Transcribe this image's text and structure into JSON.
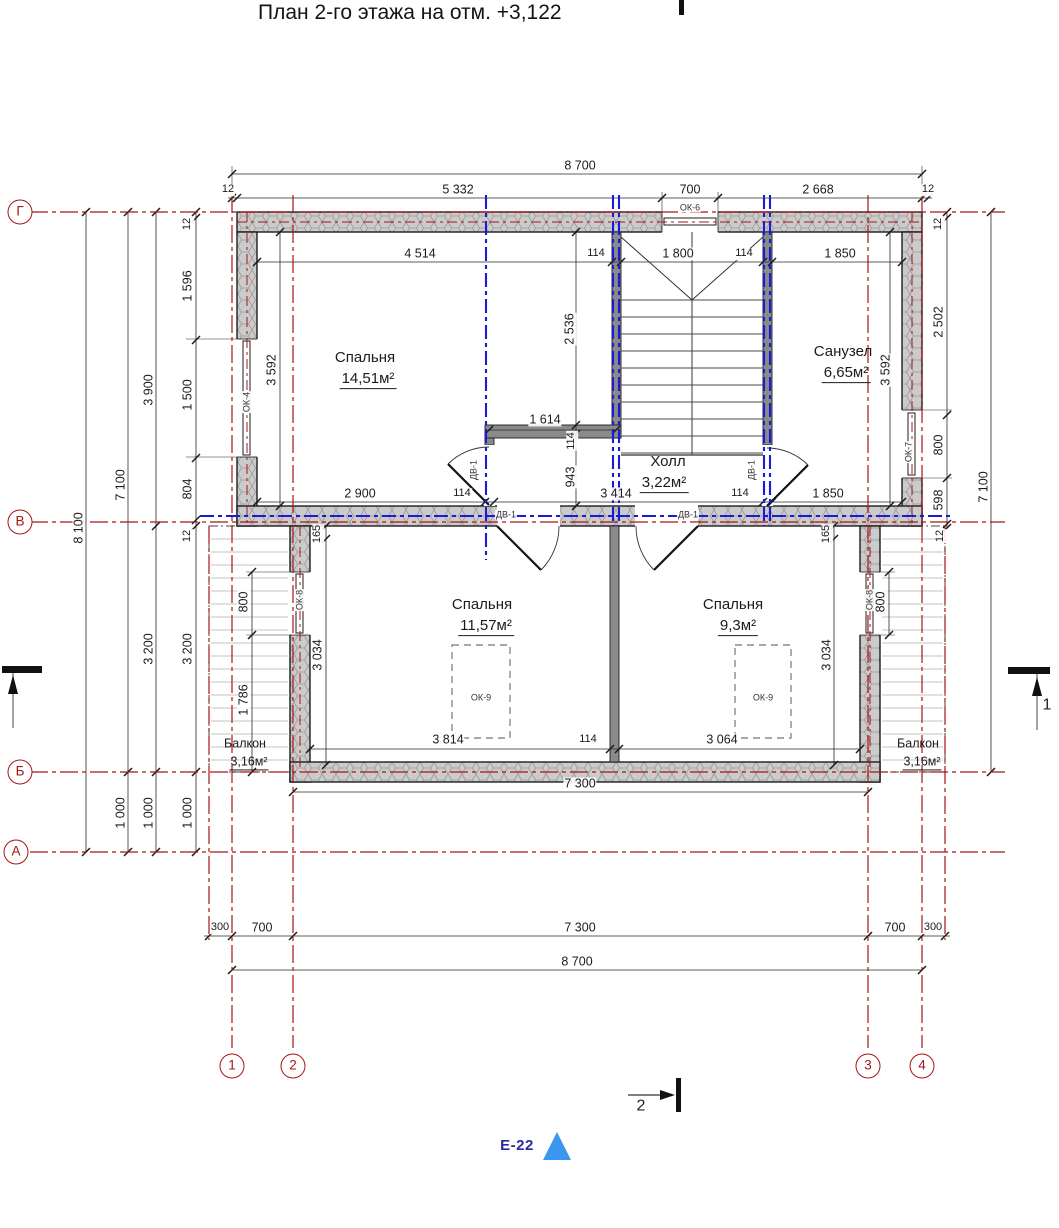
{
  "title": "План 2-го этажа на отм. +3,122",
  "colors": {
    "axis_red": "#a81414",
    "line_blue": "#1b1bd6",
    "accent_blue": "#3b96ee",
    "sheet_blue": "#2a2a9e",
    "wall_fill": "#cccccc"
  },
  "labels": [
    {
      "text": "8 700",
      "x": 580,
      "y": 166,
      "name": "dim-top-overall"
    },
    {
      "text": "12",
      "x": 228,
      "y": 190,
      "cls": "sm",
      "name": "dim"
    },
    {
      "text": "5 332",
      "x": 458,
      "y": 190,
      "name": "dim"
    },
    {
      "text": "700",
      "x": 690,
      "y": 190,
      "name": "dim"
    },
    {
      "text": "2 668",
      "x": 818,
      "y": 190,
      "name": "dim"
    },
    {
      "text": "12",
      "x": 928,
      "y": 190,
      "cls": "sm",
      "name": "dim"
    },
    {
      "text": "ОК-6",
      "x": 690,
      "y": 208,
      "cls": "tag",
      "name": "window-tag"
    },
    {
      "text": "4 514",
      "x": 420,
      "y": 254,
      "name": "dim"
    },
    {
      "text": "114",
      "x": 596,
      "y": 254,
      "cls": "sm",
      "name": "dim"
    },
    {
      "text": "1 800",
      "x": 678,
      "y": 254,
      "name": "dim"
    },
    {
      "text": "114",
      "x": 744,
      "y": 254,
      "cls": "sm",
      "name": "dim"
    },
    {
      "text": "1 850",
      "x": 840,
      "y": 254,
      "name": "dim"
    },
    {
      "text": "12",
      "x": 188,
      "y": 224,
      "rot": -90,
      "cls": "sm",
      "name": "dim"
    },
    {
      "text": "1 596",
      "x": 188,
      "y": 286,
      "rot": -90,
      "name": "dim"
    },
    {
      "text": "1 500",
      "x": 188,
      "y": 395,
      "rot": -90,
      "name": "dim"
    },
    {
      "text": "804",
      "x": 188,
      "y": 489,
      "rot": -90,
      "name": "dim"
    },
    {
      "text": "12",
      "x": 188,
      "y": 536,
      "rot": -90,
      "cls": "sm",
      "name": "dim"
    },
    {
      "text": "3 200",
      "x": 188,
      "y": 649,
      "rot": -90,
      "name": "dim"
    },
    {
      "text": "1 000",
      "x": 188,
      "y": 813,
      "rot": -90,
      "name": "dim"
    },
    {
      "text": "3 900",
      "x": 149,
      "y": 390,
      "rot": -90,
      "name": "dim"
    },
    {
      "text": "3 200",
      "x": 149,
      "y": 649,
      "rot": -90,
      "name": "dim"
    },
    {
      "text": "1 000",
      "x": 149,
      "y": 813,
      "rot": -90,
      "name": "dim"
    },
    {
      "text": "7 100",
      "x": 121,
      "y": 485,
      "rot": -90,
      "name": "dim"
    },
    {
      "text": "1 000",
      "x": 121,
      "y": 813,
      "rot": -90,
      "name": "dim"
    },
    {
      "text": "8 100",
      "x": 79,
      "y": 528,
      "rot": -90,
      "name": "dim-left-overall"
    },
    {
      "text": "12",
      "x": 939,
      "y": 224,
      "rot": -90,
      "cls": "sm",
      "name": "dim"
    },
    {
      "text": "2 502",
      "x": 939,
      "y": 322,
      "rot": -90,
      "name": "dim"
    },
    {
      "text": "800",
      "x": 939,
      "y": 445,
      "rot": -90,
      "name": "dim"
    },
    {
      "text": "598",
      "x": 939,
      "y": 500,
      "rot": -90,
      "name": "dim"
    },
    {
      "text": "12",
      "x": 941,
      "y": 536,
      "rot": -90,
      "cls": "sm",
      "name": "dim"
    },
    {
      "text": "7 100",
      "x": 984,
      "y": 487,
      "rot": -90,
      "name": "dim-right-overall"
    },
    {
      "text": "3 592",
      "x": 272,
      "y": 370,
      "rot": -90,
      "name": "dim"
    },
    {
      "text": "ОК-4",
      "x": 247,
      "y": 402,
      "rot": -90,
      "cls": "tag",
      "name": "window-tag"
    },
    {
      "text": "Спальня",
      "x": 365,
      "y": 358,
      "cls": "room",
      "name": "room-name"
    },
    {
      "text": "14,51м²",
      "x": 368,
      "y": 380,
      "cls": "area",
      "name": "room-area"
    },
    {
      "text": "2 536",
      "x": 570,
      "y": 329,
      "rot": -90,
      "name": "dim"
    },
    {
      "text": "1 614",
      "x": 545,
      "y": 420,
      "name": "dim"
    },
    {
      "text": "114",
      "x": 572,
      "y": 441,
      "rot": -90,
      "cls": "sm",
      "name": "dim"
    },
    {
      "text": "943",
      "x": 571,
      "y": 477,
      "rot": -90,
      "name": "dim"
    },
    {
      "text": "Санузел",
      "x": 843,
      "y": 352,
      "cls": "room",
      "name": "room-name"
    },
    {
      "text": "6,65м²",
      "x": 846,
      "y": 374,
      "cls": "area",
      "name": "room-area"
    },
    {
      "text": "3 592",
      "x": 886,
      "y": 370,
      "rot": -90,
      "name": "dim"
    },
    {
      "text": "ОК-7",
      "x": 909,
      "y": 452,
      "rot": -90,
      "cls": "tag",
      "name": "window-tag"
    },
    {
      "text": "Холл",
      "x": 668,
      "y": 462,
      "cls": "room",
      "name": "room-name"
    },
    {
      "text": "3,22м²",
      "x": 664,
      "y": 484,
      "cls": "area",
      "name": "room-area"
    },
    {
      "text": "ДВ-1",
      "x": 474,
      "y": 470,
      "rot": -90,
      "cls": "tag",
      "name": "door-tag"
    },
    {
      "text": "ДВ-1",
      "x": 752,
      "y": 470,
      "rot": -90,
      "cls": "tag",
      "name": "door-tag"
    },
    {
      "text": "2 900",
      "x": 360,
      "y": 494,
      "name": "dim"
    },
    {
      "text": "114",
      "x": 462,
      "y": 494,
      "cls": "sm",
      "name": "dim"
    },
    {
      "text": "3 414",
      "x": 616,
      "y": 494,
      "name": "dim"
    },
    {
      "text": "114",
      "x": 740,
      "y": 494,
      "cls": "sm",
      "name": "dim"
    },
    {
      "text": "1 850",
      "x": 828,
      "y": 494,
      "name": "dim"
    },
    {
      "text": "ДВ-1",
      "x": 506,
      "y": 515,
      "cls": "tag",
      "name": "door-tag"
    },
    {
      "text": "ДВ-1",
      "x": 688,
      "y": 515,
      "cls": "tag",
      "name": "door-tag"
    },
    {
      "text": "165",
      "x": 318,
      "y": 534,
      "rot": -90,
      "cls": "sm",
      "name": "dim"
    },
    {
      "text": "165",
      "x": 827,
      "y": 534,
      "rot": -90,
      "cls": "sm",
      "name": "dim"
    },
    {
      "text": "800",
      "x": 244,
      "y": 602,
      "rot": -90,
      "name": "dim"
    },
    {
      "text": "1 786",
      "x": 244,
      "y": 700,
      "rot": -90,
      "name": "dim"
    },
    {
      "text": "ОК-8",
      "x": 300,
      "y": 600,
      "rot": -90,
      "cls": "tag",
      "name": "window-tag"
    },
    {
      "text": "3 034",
      "x": 318,
      "y": 655,
      "rot": -90,
      "name": "dim"
    },
    {
      "text": "Спальня",
      "x": 482,
      "y": 605,
      "cls": "room",
      "name": "room-name"
    },
    {
      "text": "11,57м²",
      "x": 486,
      "y": 627,
      "cls": "area",
      "name": "room-area"
    },
    {
      "text": "ОК-9",
      "x": 481,
      "y": 698,
      "cls": "tag",
      "name": "window-tag"
    },
    {
      "text": "3 814",
      "x": 448,
      "y": 740,
      "name": "dim"
    },
    {
      "text": "114",
      "x": 588,
      "y": 740,
      "cls": "sm",
      "name": "dim"
    },
    {
      "text": "Спальня",
      "x": 733,
      "y": 605,
      "cls": "room",
      "name": "room-name"
    },
    {
      "text": "9,3м²",
      "x": 738,
      "y": 627,
      "cls": "area",
      "name": "room-area"
    },
    {
      "text": "ОК-9",
      "x": 763,
      "y": 698,
      "cls": "tag",
      "name": "window-tag"
    },
    {
      "text": "3 064",
      "x": 722,
      "y": 740,
      "name": "dim"
    },
    {
      "text": "3 034",
      "x": 827,
      "y": 655,
      "rot": -90,
      "name": "dim"
    },
    {
      "text": "ОК-8",
      "x": 870,
      "y": 600,
      "rot": -90,
      "cls": "tag",
      "name": "window-tag"
    },
    {
      "text": "800",
      "x": 881,
      "y": 602,
      "rot": -90,
      "name": "dim"
    },
    {
      "text": "Балкон",
      "x": 245,
      "y": 744,
      "cls": "room-sm",
      "name": "room-name"
    },
    {
      "text": "3,16м²",
      "x": 249,
      "y": 763,
      "cls": "area-sm",
      "name": "room-area"
    },
    {
      "text": "Балкон",
      "x": 918,
      "y": 744,
      "cls": "room-sm",
      "name": "room-name"
    },
    {
      "text": "3,16м²",
      "x": 922,
      "y": 763,
      "cls": "area-sm",
      "name": "room-area"
    },
    {
      "text": "7 300",
      "x": 580,
      "y": 784,
      "name": "dim"
    },
    {
      "text": "300",
      "x": 220,
      "y": 928,
      "cls": "sm",
      "name": "dim"
    },
    {
      "text": "700",
      "x": 262,
      "y": 928,
      "name": "dim"
    },
    {
      "text": "7 300",
      "x": 580,
      "y": 928,
      "name": "dim"
    },
    {
      "text": "700",
      "x": 895,
      "y": 928,
      "name": "dim"
    },
    {
      "text": "300",
      "x": 933,
      "y": 928,
      "cls": "sm",
      "name": "dim"
    },
    {
      "text": "8 700",
      "x": 577,
      "y": 962,
      "name": "dim-bottom-overall"
    },
    {
      "text": "Г",
      "x": 20,
      "y": 212,
      "cls": "bubble",
      "name": "axis-bubble-g"
    },
    {
      "text": "В",
      "x": 20,
      "y": 522,
      "cls": "bubble",
      "name": "axis-bubble-v"
    },
    {
      "text": "Б",
      "x": 20,
      "y": 772,
      "cls": "bubble",
      "name": "axis-bubble-b"
    },
    {
      "text": "А",
      "x": 16,
      "y": 852,
      "cls": "bubble",
      "name": "axis-bubble-a"
    },
    {
      "text": "1",
      "x": 232,
      "y": 1066,
      "cls": "bubble",
      "name": "axis-bubble-1"
    },
    {
      "text": "2",
      "x": 293,
      "y": 1066,
      "cls": "bubble",
      "name": "axis-bubble-2"
    },
    {
      "text": "3",
      "x": 868,
      "y": 1066,
      "cls": "bubble",
      "name": "axis-bubble-3"
    },
    {
      "text": "4",
      "x": 922,
      "y": 1066,
      "cls": "bubble",
      "name": "axis-bubble-4"
    },
    {
      "text": "1",
      "x": 1047,
      "y": 706,
      "cls": "sec",
      "name": "section-label-1"
    },
    {
      "text": "2",
      "x": 641,
      "y": 1107,
      "cls": "sec",
      "name": "section-label-2"
    },
    {
      "text": "Е-22",
      "x": 517,
      "y": 1146,
      "cls": "sheet",
      "name": "sheet-tag"
    }
  ]
}
